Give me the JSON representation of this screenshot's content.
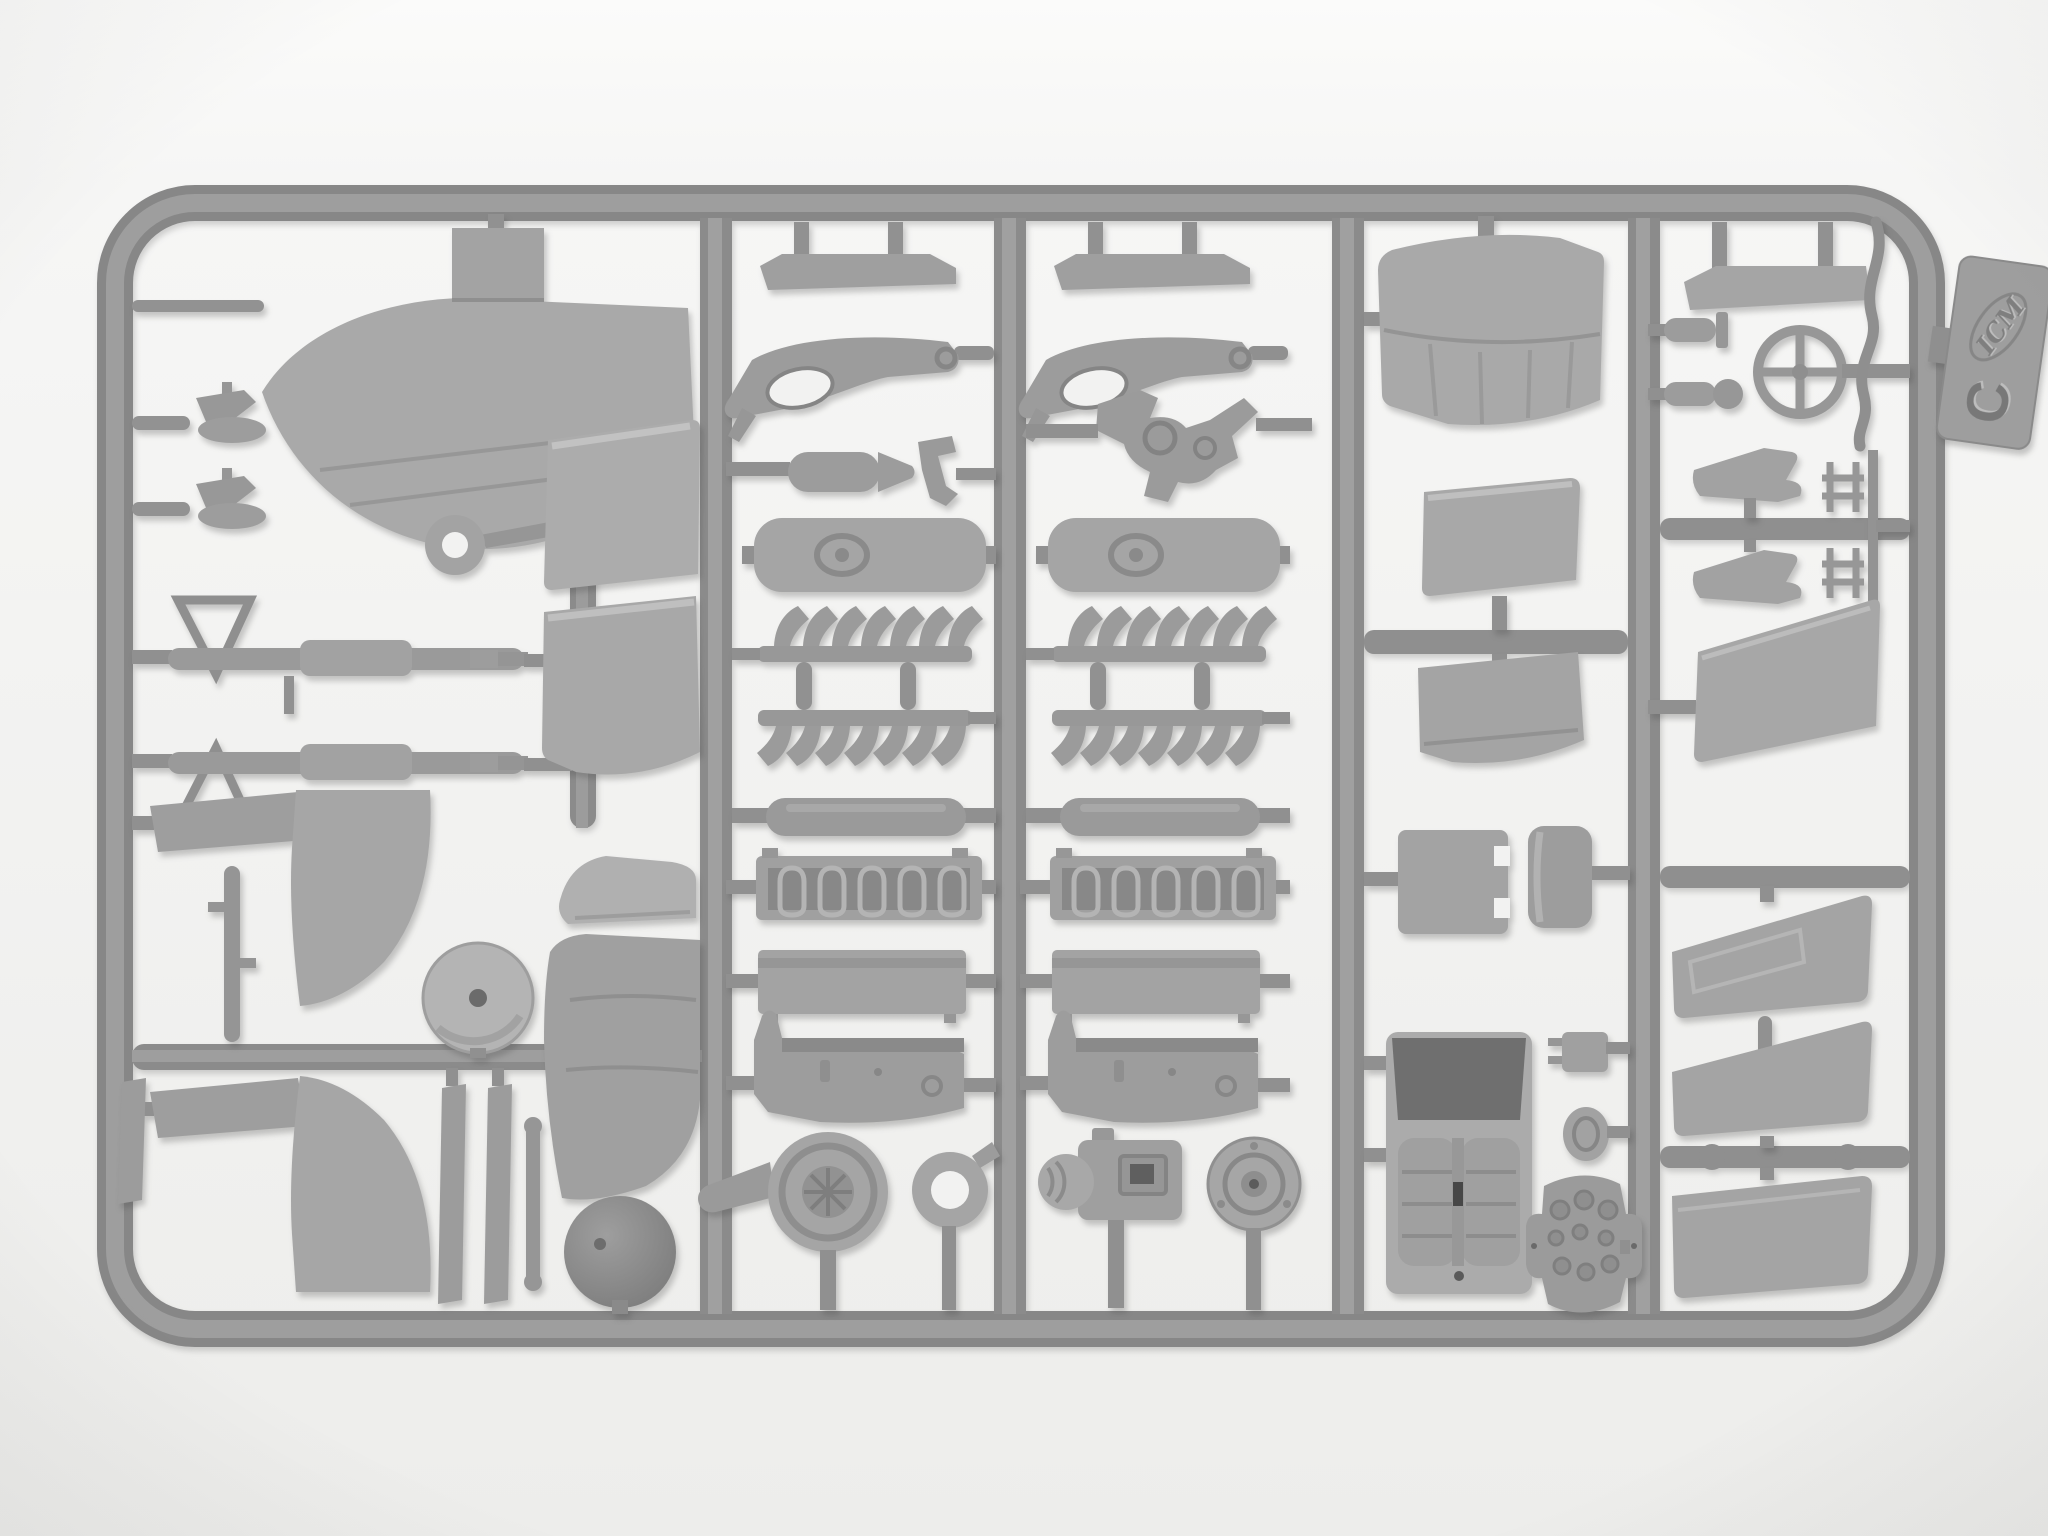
{
  "meta": {
    "description": "Photograph of a grey injection-molded plastic model kit sprue (parts frame) of an aircraft kit, lying on a white background",
    "subject": "model-kit-sprue",
    "orientation": "landscape"
  },
  "tag": {
    "brand": "ICM",
    "sprue_letter": "C"
  },
  "palette": {
    "background_top": "#fafaf9",
    "background_bottom": "#eeeeec",
    "runner": "#8e8e8e",
    "runner_highlight": "#a5a5a5",
    "plastic_light": "#b3b3b3",
    "plastic_mid": "#a5a5a5",
    "plastic_dark": "#8b8b8b",
    "cavity_dark": "#6f6f6f",
    "shadow": "rgba(70,70,70,0.28)"
  },
  "structure": {
    "outer_frame": "rounded rectangle",
    "internal_vertical_runners": 4,
    "columns": 5,
    "engine_part_sets": 2,
    "exhaust_fins_per_row": 7,
    "cylinder_bank_loops": 5,
    "aileron_panels_right_column": 3
  },
  "parts": [
    {
      "id": "fin-tip",
      "name": "stabilizer tip with root tab"
    },
    {
      "id": "lever-1",
      "name": "small control lever"
    },
    {
      "id": "lever-2",
      "name": "small control lever"
    },
    {
      "id": "ring-eyelet",
      "name": "eyelet ring"
    },
    {
      "id": "gun-1",
      "name": "machine gun with triangular mount"
    },
    {
      "id": "gun-2",
      "name": "machine gun with triangular mount"
    },
    {
      "id": "elevator-1",
      "name": "elevator panel"
    },
    {
      "id": "elevator-2",
      "name": "elevator panel"
    },
    {
      "id": "boat-fairing",
      "name": "small fairing"
    },
    {
      "id": "fin-large",
      "name": "vertical fin half"
    },
    {
      "id": "wheel-disc",
      "name": "wheel cover disc"
    },
    {
      "id": "spinner-dome",
      "name": "propeller spinner dome"
    },
    {
      "id": "axe-spat-1",
      "name": "wheel spat half with blade"
    },
    {
      "id": "axe-spat-2",
      "name": "wheel spat half with blade"
    },
    {
      "id": "t-rod",
      "name": "linkage rod"
    },
    {
      "id": "strut-slats",
      "name": "interplane strut blades"
    },
    {
      "id": "step-bar",
      "name": "walkway step strip"
    },
    {
      "id": "gear-bracket",
      "name": "landing gear bracket"
    },
    {
      "id": "bomb-tank",
      "name": "small bomb / tank"
    },
    {
      "id": "chair-clip",
      "name": "bracket clip"
    },
    {
      "id": "boss-panel",
      "name": "access panel with oval boss"
    },
    {
      "id": "exhaust-row-up",
      "name": "exhaust stub row"
    },
    {
      "id": "exhaust-row-down",
      "name": "exhaust stub row"
    },
    {
      "id": "cylinder-tube",
      "name": "engine cylinder tube"
    },
    {
      "id": "cylinder-bank",
      "name": "engine cylinder bank with springs"
    },
    {
      "id": "valve-block",
      "name": "engine valve cover block"
    },
    {
      "id": "crankcase",
      "name": "engine crankcase"
    },
    {
      "id": "supercharger",
      "name": "supercharger with volute inlet"
    },
    {
      "id": "ring-part",
      "name": "ring collar"
    },
    {
      "id": "engine-mount",
      "name": "engine mount frame"
    },
    {
      "id": "magneto",
      "name": "magneto housing"
    },
    {
      "id": "round-dial",
      "name": "round accessory drive"
    },
    {
      "id": "tailplane",
      "name": "tailplane half"
    },
    {
      "id": "cowl-panel-1",
      "name": "cowling panel"
    },
    {
      "id": "cowl-panel-2",
      "name": "cowling panel"
    },
    {
      "id": "hatch-panel",
      "name": "square hatch panel"
    },
    {
      "id": "rolled-panel",
      "name": "curved cowl strip"
    },
    {
      "id": "cockpit-tub",
      "name": "cockpit floor with seats"
    },
    {
      "id": "plug-part",
      "name": "two-prong plug"
    },
    {
      "id": "oval-grommet",
      "name": "oval grommet"
    },
    {
      "id": "instrument-panel",
      "name": "instrument panel with dials"
    },
    {
      "id": "heat-shield",
      "name": "heat shield strip"
    },
    {
      "id": "bullet-knob-1",
      "name": "pitot / bullet fairing"
    },
    {
      "id": "bullet-knob-2",
      "name": "pitot / bullet fairing"
    },
    {
      "id": "control-wheel",
      "name": "control wheel"
    },
    {
      "id": "wire-rod",
      "name": "bent wire linkage"
    },
    {
      "id": "dagger-blade-1",
      "name": "trowel blade part"
    },
    {
      "id": "dagger-blade-2",
      "name": "trowel blade part"
    },
    {
      "id": "h-clip-1",
      "name": "H-shaped clamp"
    },
    {
      "id": "h-clip-2",
      "name": "H-shaped clamp"
    },
    {
      "id": "walkway-flap",
      "name": "large flap panel"
    },
    {
      "id": "aileron-1",
      "name": "aileron panel"
    },
    {
      "id": "aileron-2",
      "name": "aileron panel"
    },
    {
      "id": "aileron-3",
      "name": "aileron panel"
    }
  ]
}
